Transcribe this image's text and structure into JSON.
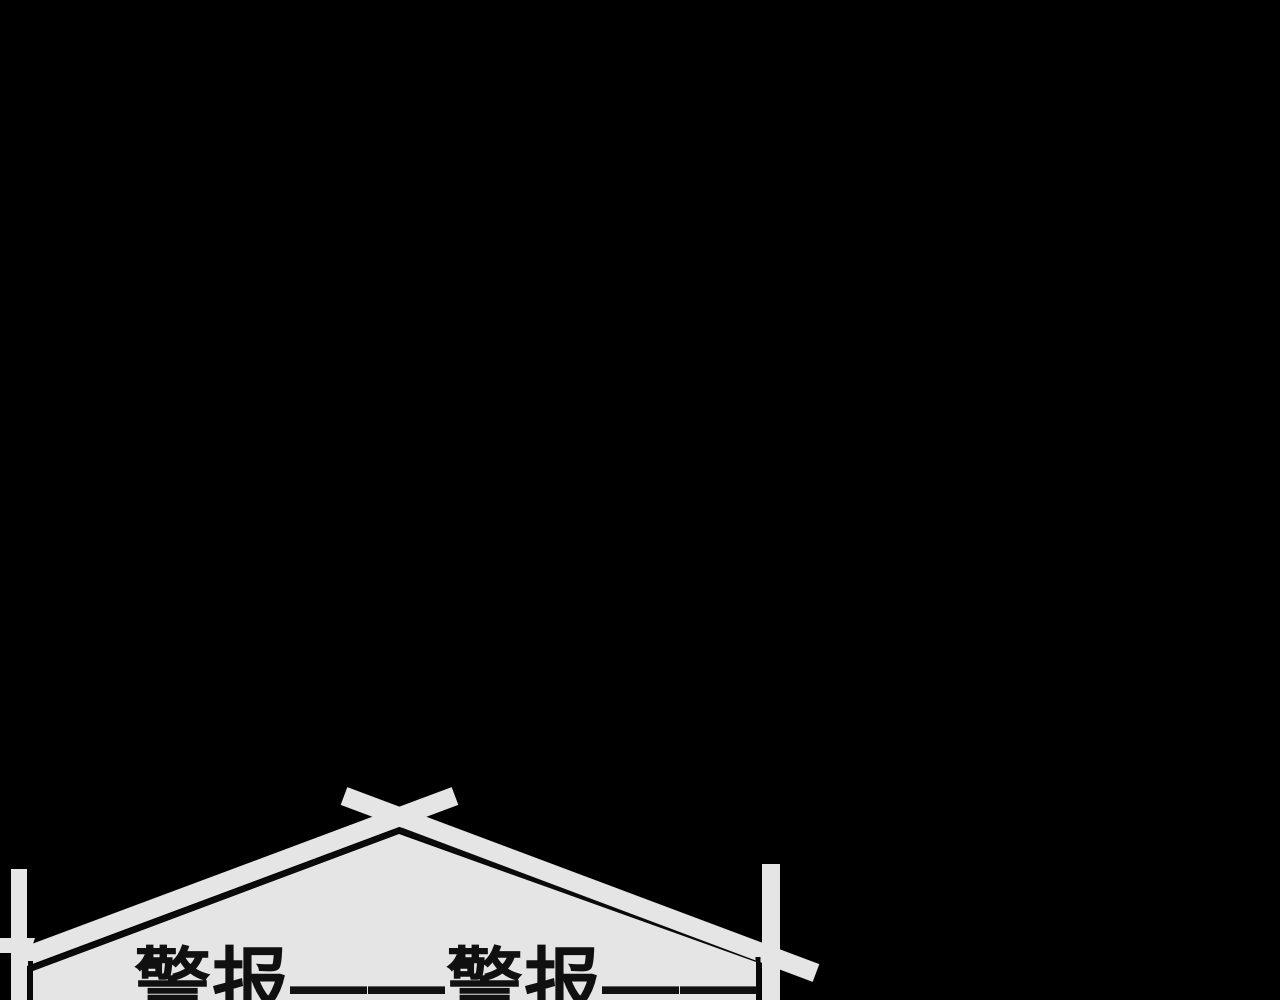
{
  "panel": {
    "background_color": "#000000",
    "bubble": {
      "shape": "house-signboard",
      "fill_color": "#e5e5e5",
      "outline_color": "#0a0a0a",
      "text": "警报——警报——",
      "text_color": "#101010"
    }
  }
}
